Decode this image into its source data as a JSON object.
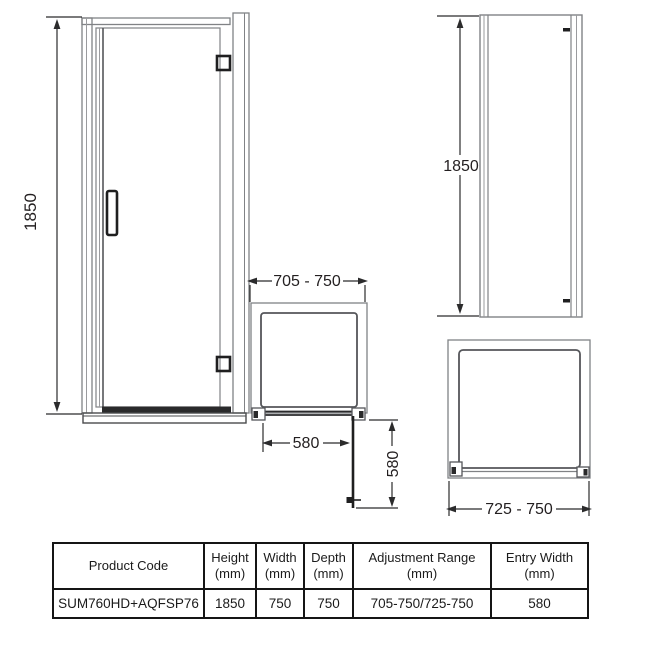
{
  "drawing": {
    "front_view": {
      "height_dim": "1850"
    },
    "side_view": {
      "height_dim": "1850"
    },
    "plan_view_door": {
      "width_dim": "705 - 750",
      "entry_width_dim": "580",
      "door_projection_dim": "580"
    },
    "plan_view_panel": {
      "width_dim": "725 - 750"
    }
  },
  "table": {
    "headers": [
      {
        "lines": [
          "Product Code"
        ]
      },
      {
        "lines": [
          "Height",
          "(mm)"
        ]
      },
      {
        "lines": [
          "Width",
          "(mm)"
        ]
      },
      {
        "lines": [
          "Depth",
          "(mm)"
        ]
      },
      {
        "lines": [
          "Adjustment Range",
          "(mm)"
        ]
      },
      {
        "lines": [
          "Entry Width",
          "(mm)"
        ]
      }
    ],
    "row": [
      "SUM760HD+AQFSP76",
      "1850",
      "750",
      "750",
      "705-750/725-750",
      "580"
    ]
  },
  "colors": {
    "frame_line": "#808285",
    "panel_line": "#55565a",
    "dark_detail": "#1f1f20",
    "dimension": "#2b2b2c",
    "table_border": "#151515"
  }
}
